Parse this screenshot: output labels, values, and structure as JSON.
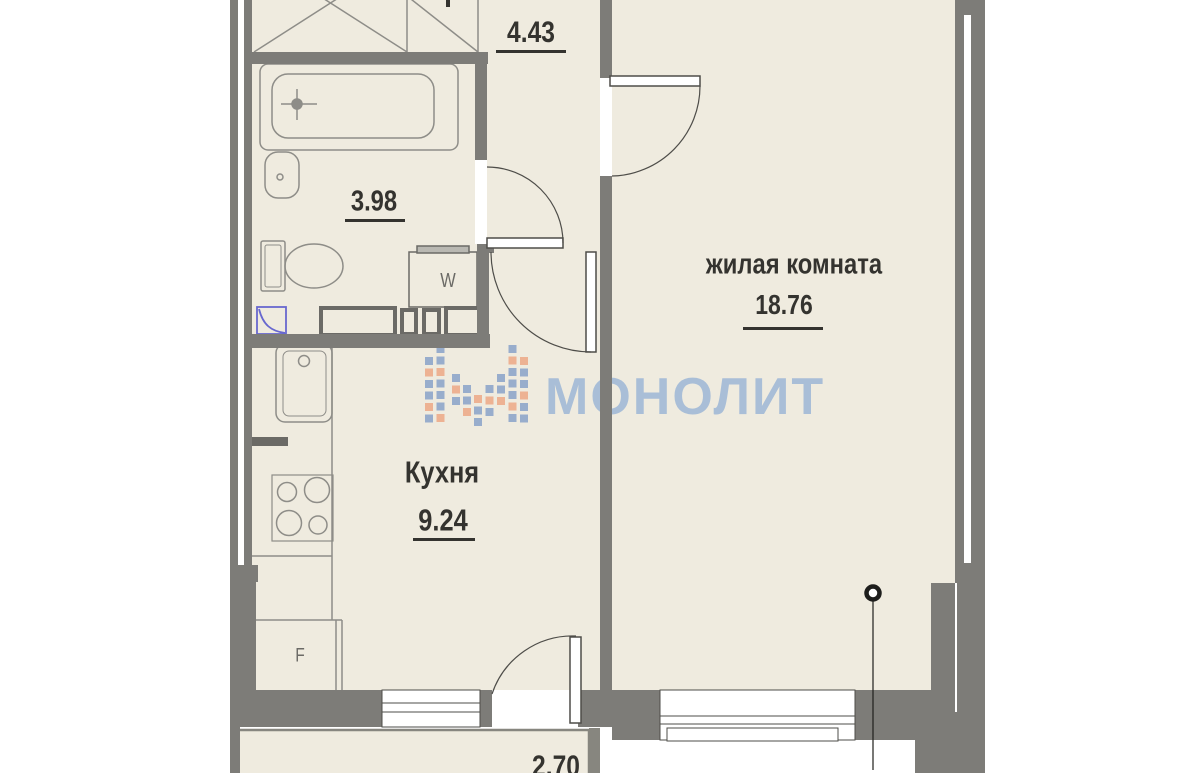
{
  "plan": {
    "type": "apartment floor plan",
    "rooms": {
      "hallway": {
        "area": "4.43"
      },
      "bathroom": {
        "area": "3.98"
      },
      "kitchen": {
        "name": "Кухня",
        "area": "9.24"
      },
      "living_room": {
        "name": "жилая комната",
        "area": "18.76"
      },
      "balcony": {
        "area": "2.70"
      }
    },
    "appliances": {
      "washing_machine_label": "W",
      "fridge_label": "F"
    }
  },
  "watermark": {
    "brand": "МОНОЛИТ",
    "text_color": "#9db7d6",
    "logo_blue": "#8aa3c9",
    "logo_orange": "#eda océ986"
  },
  "colors": {
    "wall": "#7d7c78",
    "floor": "#efebdf",
    "furniture_line": "#8e8d88",
    "dark_line": "#4e4d49",
    "box_border": "#6b6a66",
    "marker_blue": "#6868cf",
    "label_text": "#34332f"
  }
}
